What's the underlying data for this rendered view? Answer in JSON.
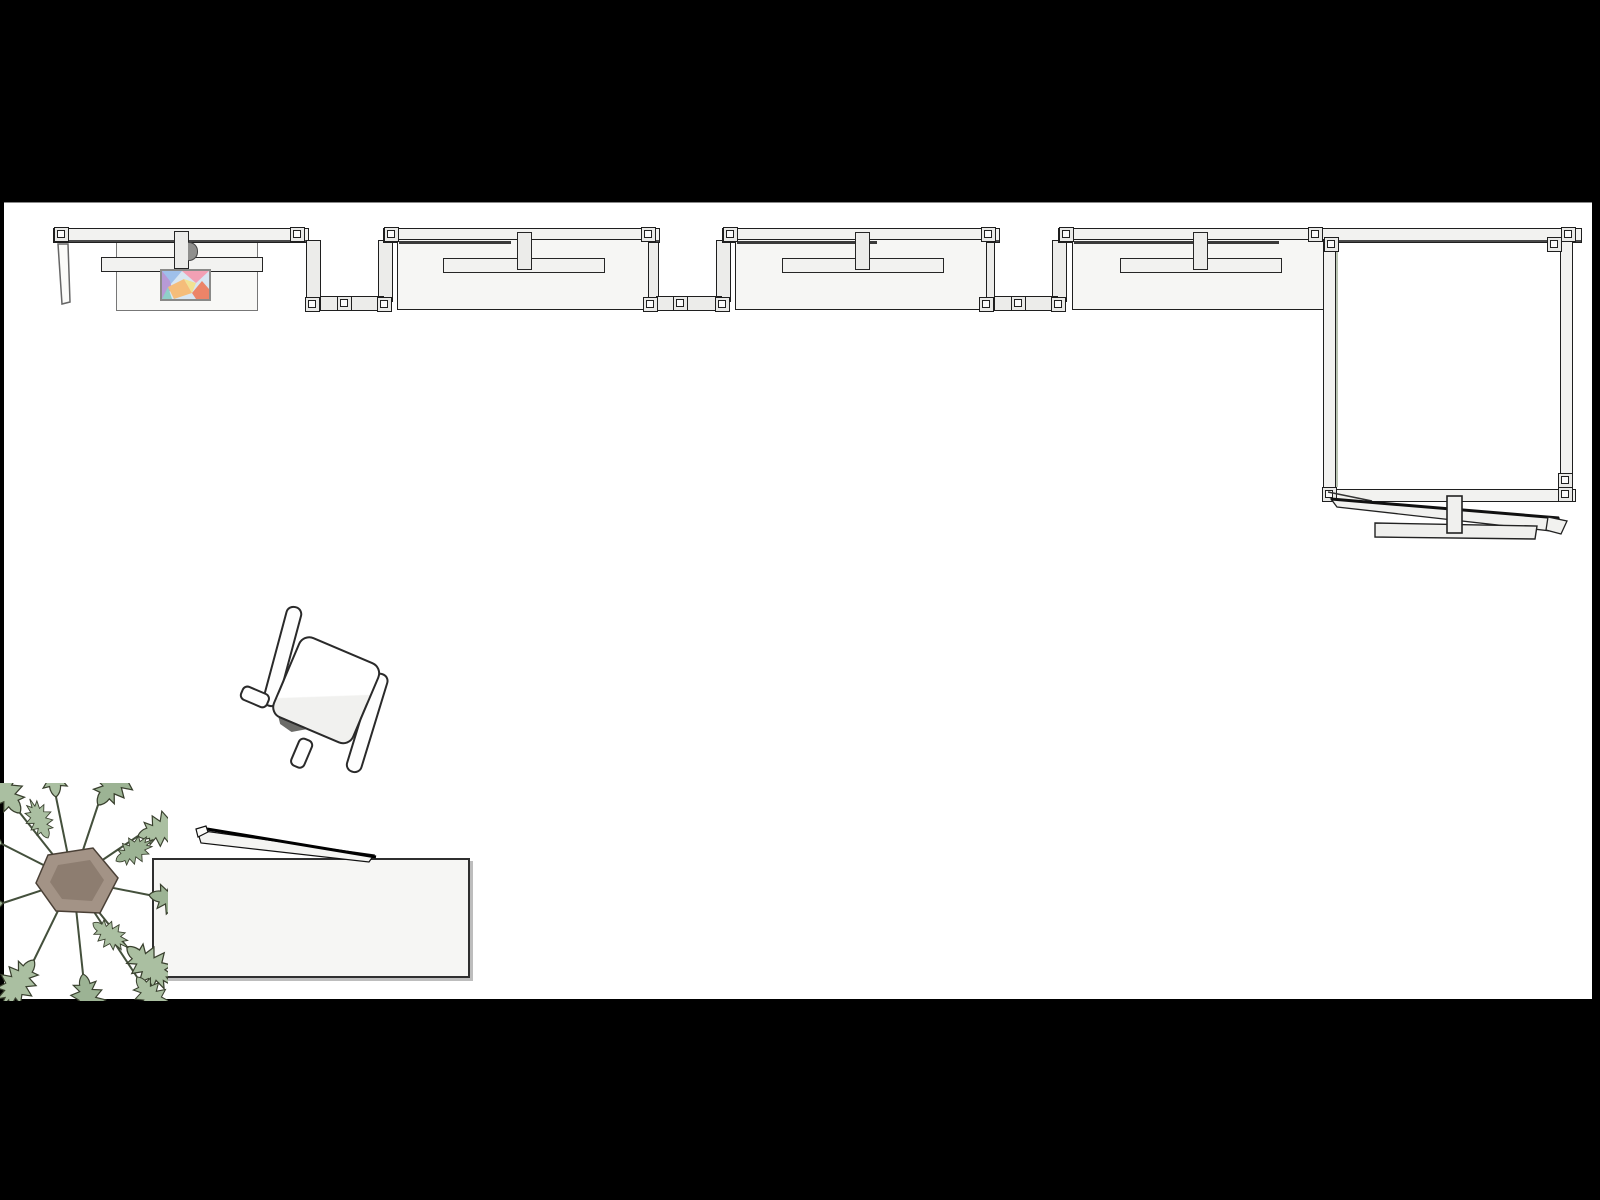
{
  "scene": {
    "description": "Top-down plan view of a modular frame booth: one desk module with a colorful screen, three partition desk modules linked by low frame bars, an enclosed square room with loose planks below it, a swivel chair, a monstera plant and a rectangular table with a leaning plank",
    "view": "plan-top-down",
    "background_color": "#000000",
    "canvas_color": "#ffffff",
    "objects": [
      {
        "name": "desk-module-with-screen",
        "count": 1
      },
      {
        "name": "partition-desk-module",
        "count": 3
      },
      {
        "name": "frame-link",
        "count": 3
      },
      {
        "name": "enclosed-room",
        "count": 1
      },
      {
        "name": "loose-planks-and-post",
        "count": 1
      },
      {
        "name": "swivel-chair",
        "count": 1
      },
      {
        "name": "monstera-plant",
        "count": 1
      },
      {
        "name": "rectangular-table",
        "count": 1
      },
      {
        "name": "leaning-plank",
        "count": 1
      }
    ],
    "colors": {
      "frame_fill": "#f2f2f0",
      "panel_fill": "#f6f6f4",
      "outline": "#1f1f1f",
      "shadow_line": "#3a3a3a",
      "block_fill": "#e9e9e7",
      "leaf_green": "#aabfa1",
      "leaf_green_alt": "#9cb394",
      "leaf_outline": "#39402e",
      "pot_fill": "#a39386",
      "pot_shade": "#8d7d70",
      "wall_accent": "#b9c4b2",
      "chair_fill": "#fefefe",
      "table_fill": "#f6f6f4",
      "screen_frame": "#8a8a88",
      "canvas": "#ffffff"
    },
    "screen_colors": [
      "#d8e6f2",
      "#9fc0ea",
      "#f2a0b4",
      "#b79ad6",
      "#8fd0c8",
      "#f5bd7a",
      "#f2e292",
      "#ec8468"
    ]
  }
}
